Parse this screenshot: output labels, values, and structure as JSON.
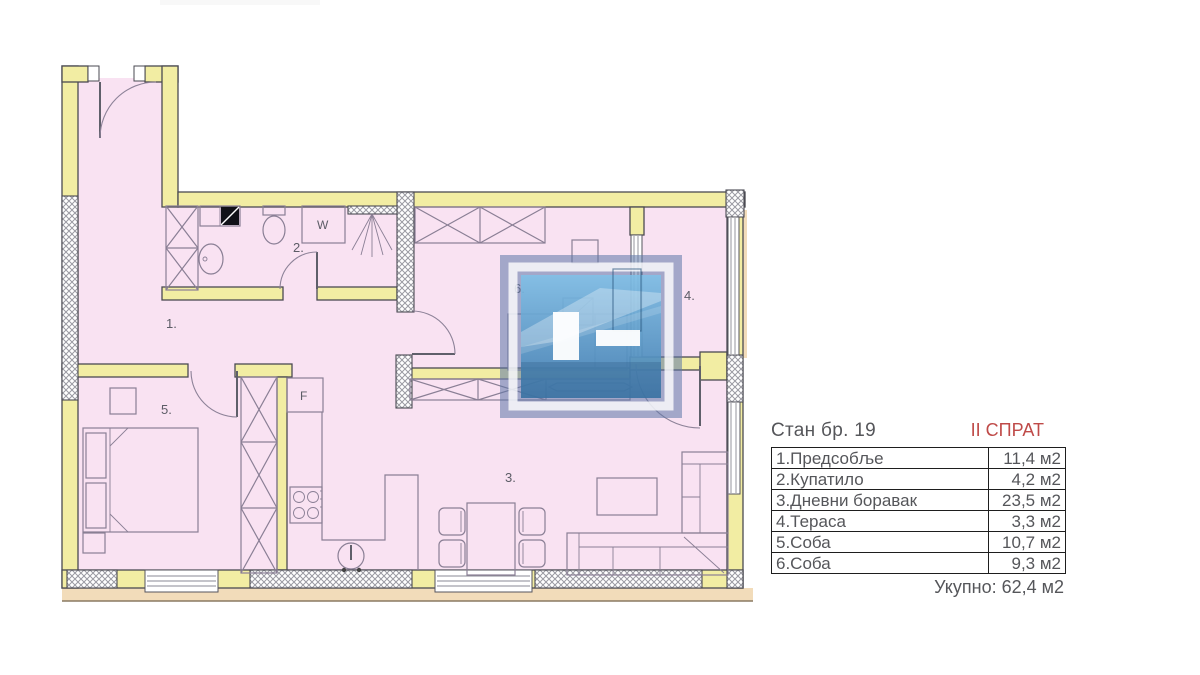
{
  "floor_plan": {
    "labels": {
      "hall": "1.",
      "bathroom": "2.",
      "living_room": "3.",
      "terrace": "4.",
      "bedroom_5": "5.",
      "bedroom_6": "6.",
      "washing_machine": "W",
      "fridge": "F"
    },
    "colors": {
      "wall_yellow": "#f2eda3",
      "room_pink": "#f9e2f2",
      "terrain_tan": "#f2dcba",
      "watermark_blue": "#5d76a8"
    }
  },
  "info_panel": {
    "title": "Стан бр. 19",
    "floor": "II СПРАТ",
    "accent_color": "#bf4a48",
    "rows": [
      {
        "label": "1.Предсобље",
        "value": "11,4 м2"
      },
      {
        "label": "2.Купатило",
        "value": "4,2 м2"
      },
      {
        "label": "3.Дневни боравак",
        "value": "23,5 м2"
      },
      {
        "label": "4.Тераса",
        "value": "3,3 м2"
      },
      {
        "label": "5.Соба",
        "value": "10,7 м2"
      },
      {
        "label": "6.Соба",
        "value": "9,3 м2"
      }
    ],
    "total": "Укупно: 62,4 м2"
  }
}
